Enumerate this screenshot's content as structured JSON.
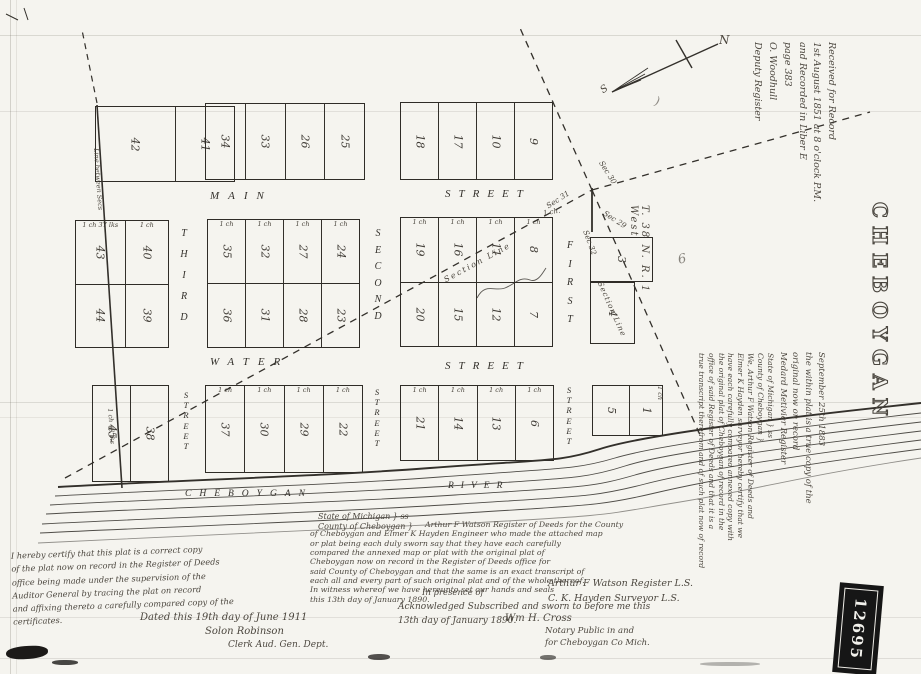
{
  "stamp_title": "CHEBOYGAN",
  "stamp_number": "12695",
  "compass": {
    "north": "N",
    "south": "S"
  },
  "township": "T. 38 N. R. 1 West",
  "sections": {
    "nw": "Sec 31",
    "ne": "Sec 30",
    "e": "Sec 29",
    "s": "Sec 32"
  },
  "section_line": "Section Line",
  "boundary_note": "Line between Secs",
  "measure_note": "1 ch 48 lks",
  "corner_chain": "1 ch.",
  "marks": {
    "paren": ")",
    "curl": "6"
  },
  "streets": {
    "main": "MAIN",
    "water": "WATER",
    "street_word": "STREET",
    "first": "FIRST",
    "second": "SECOND",
    "third": "THIRD"
  },
  "river": {
    "part1": "CHEBOYGAN",
    "part2": "RIVER"
  },
  "plat": {
    "row1": {
      "blockA": {
        "lots": [
          "42",
          "41"
        ]
      },
      "blockB": {
        "lots": [
          "34",
          "33",
          "26",
          "25"
        ]
      },
      "blockC": {
        "lots": [
          "18",
          "17",
          "10",
          "9"
        ]
      }
    },
    "row2": {
      "blockD": {
        "upper": [
          "43",
          "40"
        ],
        "lower": [
          "44",
          "39"
        ],
        "chains": [
          "1 ch 37 lks",
          "1 ch"
        ]
      },
      "blockE": {
        "upper": [
          "35",
          "32",
          "27",
          "24"
        ],
        "lower": [
          "36",
          "31",
          "28",
          "23"
        ],
        "chains": [
          "1 ch",
          "1 ch",
          "1 ch",
          "1 ch"
        ]
      },
      "blockF": {
        "upper": [
          "19",
          "16",
          "11",
          "8"
        ],
        "lower": [
          "20",
          "15",
          "12",
          "7"
        ],
        "chains": [
          "1 ch",
          "1 ch",
          "1 ch",
          "1 ch"
        ]
      },
      "lot3": "3",
      "lot4": "4"
    },
    "row3": {
      "blockH": {
        "lots": [
          "45-",
          "38"
        ]
      },
      "blockI": {
        "lots": [
          "37",
          "30",
          "29",
          "22"
        ],
        "chains": [
          "1 ch",
          "1 ch",
          "1 ch",
          "1 ch"
        ]
      },
      "blockJ": {
        "lots": [
          "21",
          "14",
          "13",
          "6"
        ],
        "chains": [
          "1 ch",
          "1 ch",
          "1 ch",
          "1 ch"
        ]
      },
      "blockK": {
        "lots": [
          "5",
          "1"
        ],
        "chains": [
          "",
          "1 ch"
        ]
      }
    }
  },
  "margin": {
    "received": [
      "Received for Record",
      "1st August 1851 at 8 o'clock P.M.",
      "and Recorded in Liber E",
      "page 383",
      "O. Woodhull",
      "Deputy Register"
    ],
    "true_copy": [
      "September 25th 1883",
      "the within plat is a true copy of the",
      "original now on record",
      "Medard Metivier Register"
    ],
    "compare_cert": [
      "State of Michigan } ss",
      "County of Cheboygan }",
      "We, Arthur F Watson Register of Deeds and",
      "Elmer K Hayden surveyor hereby certify that we",
      "have each carefully compared annexed copy with",
      "the original plat of Cheboygan of record in the",
      "office of said Register of Deeds and that it is a",
      "true transcript therefrom and of such plat now of record"
    ]
  },
  "certificates": {
    "auditor": [
      "I hereby certify that this plat is a correct copy",
      "of the plat now on record in the Register of Deeds",
      "office being made under the supervision of the",
      "Auditor General by tracing the plat on record",
      "and affixing thereto a carefully compared copy of the",
      "certificates."
    ],
    "dated_line": "Dated this 19th day of June 1911",
    "clerk_sig": "Solon Robinson",
    "clerk_title": "Clerk Aud. Gen. Dept.",
    "som": [
      "State of Michigan } ss",
      "County of Cheboygan }"
    ],
    "watson_body": [
      "Arthur F Watson Register of Deeds for the County",
      "of Cheboygan and Elmer K Hayden Engineer who made the attached map",
      "or plat being each duly sworn say that they have each carefully",
      "compared the annexed map or plat with the original plat of",
      "Cheboygan now on record in the Register of Deeds office for",
      "said County of Cheboygan and that the same is an exact transcript of",
      "each all and every part of such original plat and of the whole thereof.",
      "In witness whereof we have hereunto set our hands and seals",
      "this 13th day of January 1890."
    ],
    "presence": "In presence of",
    "sig1": "Arthur F Watson   Register    L.S.",
    "sig2": "C. K. Hayden   Surveyor    L.S.",
    "ack": [
      "Acknowledged Subscribed and sworn to before me this",
      "13th day of January 1890."
    ],
    "notary_sig": "Wm H. Cross",
    "notary_title": [
      "Notary Public in and",
      "for Cheboygan Co Mich."
    ]
  }
}
